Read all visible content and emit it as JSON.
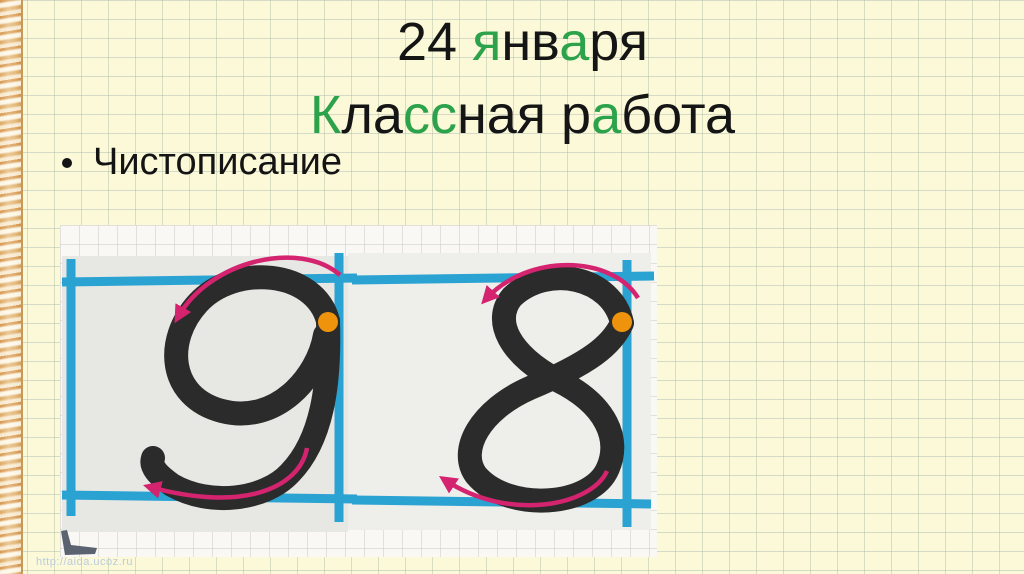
{
  "slide": {
    "title_lines": [
      {
        "segments": [
          {
            "text": "24 ",
            "color": "black"
          },
          {
            "text": "я",
            "color": "green"
          },
          {
            "text": "нв",
            "color": "black"
          },
          {
            "text": "а",
            "color": "green"
          },
          {
            "text": "ря",
            "color": "black"
          }
        ]
      },
      {
        "segments": [
          {
            "text": "К",
            "color": "green"
          },
          {
            "text": "ла",
            "color": "black"
          },
          {
            "text": "сс",
            "color": "green"
          },
          {
            "text": "ная ",
            "color": "black"
          },
          {
            "text": "р",
            "color": "black"
          },
          {
            "text": "а",
            "color": "green"
          },
          {
            "text": "бота",
            "color": "black"
          }
        ]
      }
    ],
    "bullet_text": "Чистописание",
    "watermark": "http://aida.ucoz.ru"
  },
  "practice_image": {
    "digits": [
      "9",
      "8"
    ],
    "colors": {
      "guide_line_blue": "#2aa2d2",
      "stroke_arrow_pink": "#d4246f",
      "start_dot_orange": "#f0930c",
      "digit_black": "#2b2b2b",
      "card_gray": "#e7e7e4",
      "paper_white": "#f9f8f4"
    }
  },
  "theme": {
    "accent_green": "#2ca24b",
    "text_black": "#151515",
    "background_cream": "#fbf9d8"
  }
}
